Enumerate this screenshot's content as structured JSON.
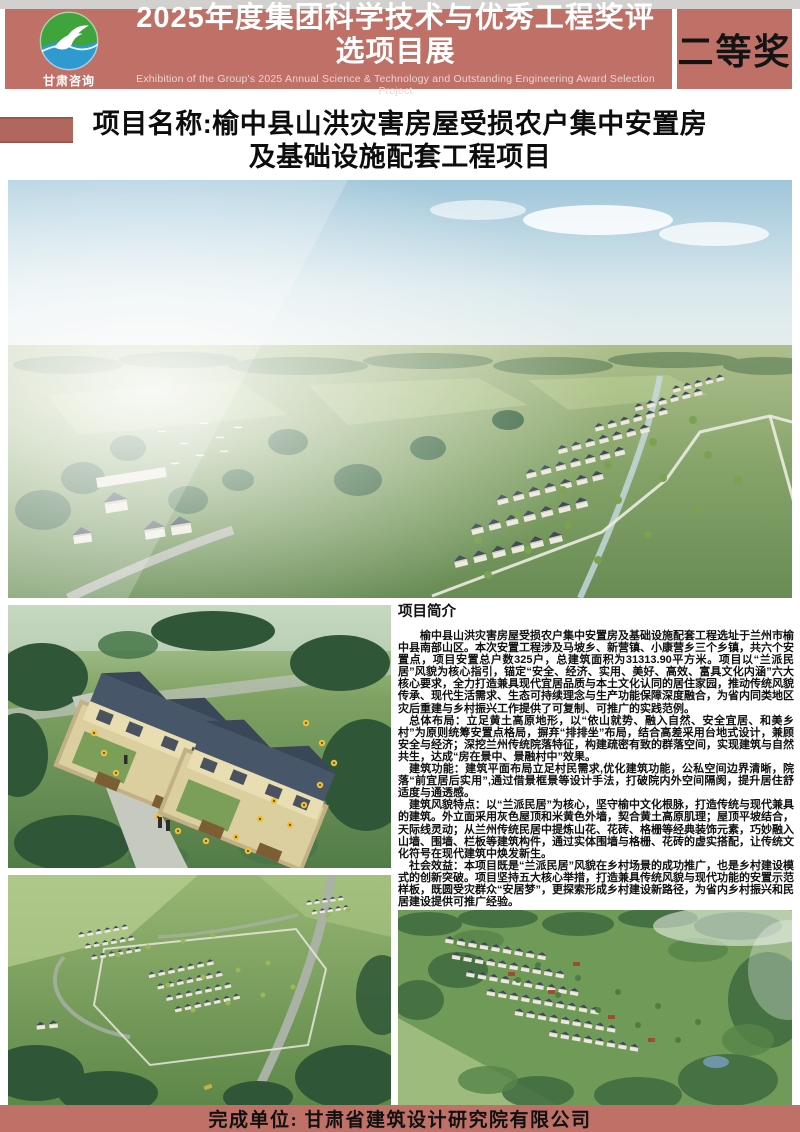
{
  "header": {
    "logo_text": "甘肃咨询",
    "title": "2025年度集团科学技术与优秀工程奖评选项目展",
    "subtitle": "Exhibition of the Group's 2025 Annual Science & Technology and Outstanding Engineering Award Selection Project",
    "award_badge": "二等奖"
  },
  "project": {
    "name_line1": "项目名称:榆中县山洪灾害房屋受损农户集中安置房",
    "name_line2": "及基础设施配套工程项目"
  },
  "intro": {
    "heading": "项目简介",
    "paragraphs": [
      "榆中县山洪灾害房屋受损农户集中安置房及基础设施配套工程选址于兰州市榆中县南部山区。本次安置工程涉及马坡乡、新营镇、小康营乡三个乡镇，共六个安置点，项目安置总户数325户，总建筑面积为31313.90平方米。项目以“兰派民居”风貌为核心指引，锚定“安全、经济、实用、美好、高效、富具文化内涵”六大核心要求，全力打造兼具现代宜居品质与本土文化认同的居住家园，推动传统风貌传承、现代生活需求、生态可持续理念与生产功能保障深度融合，为省内同类地区灾后重建与乡村振兴工作提供了可复制、可推广的实践范例。",
      "总体布局：立足黄土高原地形，以“依山就势、融入自然、安全宜居、和美乡村”为原则统筹安置点格局，摒弃“排排坐”布局，结合高差采用台地式设计，兼顾安全与经济；深挖兰州传统院落特征，构建疏密有致的群落空间，实现建筑与自然共生，达成“房在景中、景融村中”效果。",
      "建筑功能：建筑平面布局立足村民需求,优化建筑功能，公私空间边界清晰，院落“前宜居后实用”,通过借景框景等设计手法，打破院内外空间隔阂，提升居住舒适度与通透感。",
      "建筑风貌特点：以“兰派民居”为核心，坚守榆中文化根脉，打造传统与现代兼具的建筑。外立面采用灰色屋顶和米黄色外墙，契合黄土高原肌理；屋顶平坡结合，天际线灵动；从兰州传统民居中提炼山花、花砖、格栅等经典装饰元素，巧妙融入山墙、围墙、栏板等建筑构件，通过实体围墙与格栅、花砖的虚实搭配，让传统文化符号在现代建筑中焕发新生。",
      "社会效益：本项目既是“兰派民居”风貌在乡村场景的成功推广，也是乡村建设模式的创新突破。项目坚持五大核心举措，打造兼具传统风貌与现代功能的安置示范样板，既圆受灾群众“安居梦”，更探索形成乡村建设新路径，为省内乡村振兴和民居建设提供可推广经验。"
    ]
  },
  "footer": {
    "completed_by": "完成单位: 甘肃省建筑设计研究院有限公司"
  },
  "colors": {
    "banner": "#bf7168",
    "accent_block": "#b2675e",
    "top_strip": "#d3d1cf",
    "logo_green": "#3fa43c",
    "logo_blue": "#2e9ad0"
  }
}
